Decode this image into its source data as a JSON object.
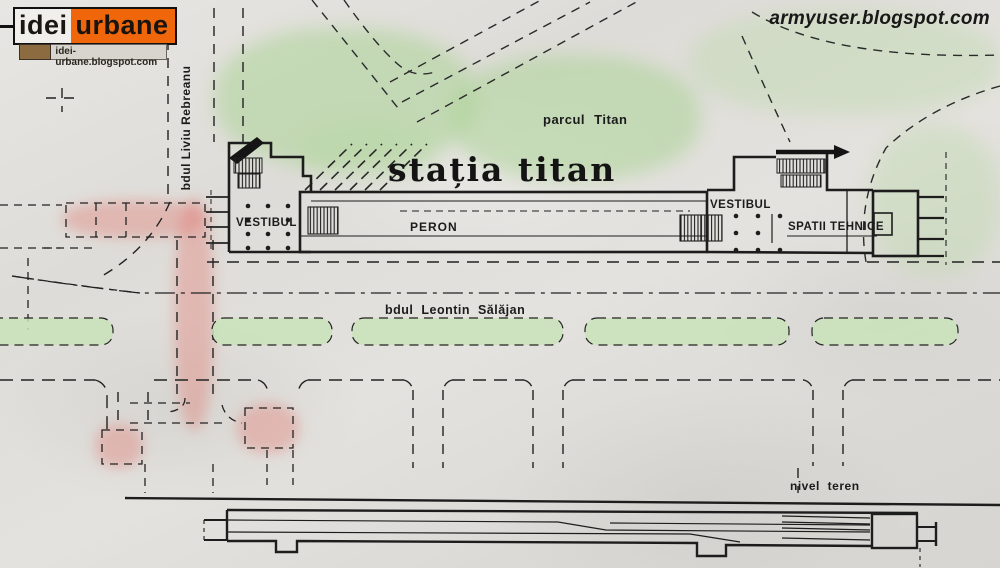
{
  "branding": {
    "logo_left": "idei",
    "logo_right": "urbane",
    "logo_url": "idei-urbane.blogspot.com",
    "watermark": "armyuser.blogspot.com"
  },
  "plan": {
    "title": "stația titan",
    "park_label": "parcul Titan",
    "street_left": "bdul Liviu Rebreanu",
    "boulevard": "bdul Leontin Sălăjan",
    "vestibule_left": "VESTIBUL",
    "vestibule_right": "VESTIBUL",
    "platform": "PERON",
    "technical": "SPATII TEHNICE",
    "ground_level": "nivel teren"
  },
  "colors": {
    "paper": "#e3e1dd",
    "ink": "#1d1d1d",
    "park_green": "#cbe4bb",
    "highlight_pink": "#eaa9a2",
    "logo_orange": "#f0660a",
    "logo_brown": "#8d6b40"
  }
}
